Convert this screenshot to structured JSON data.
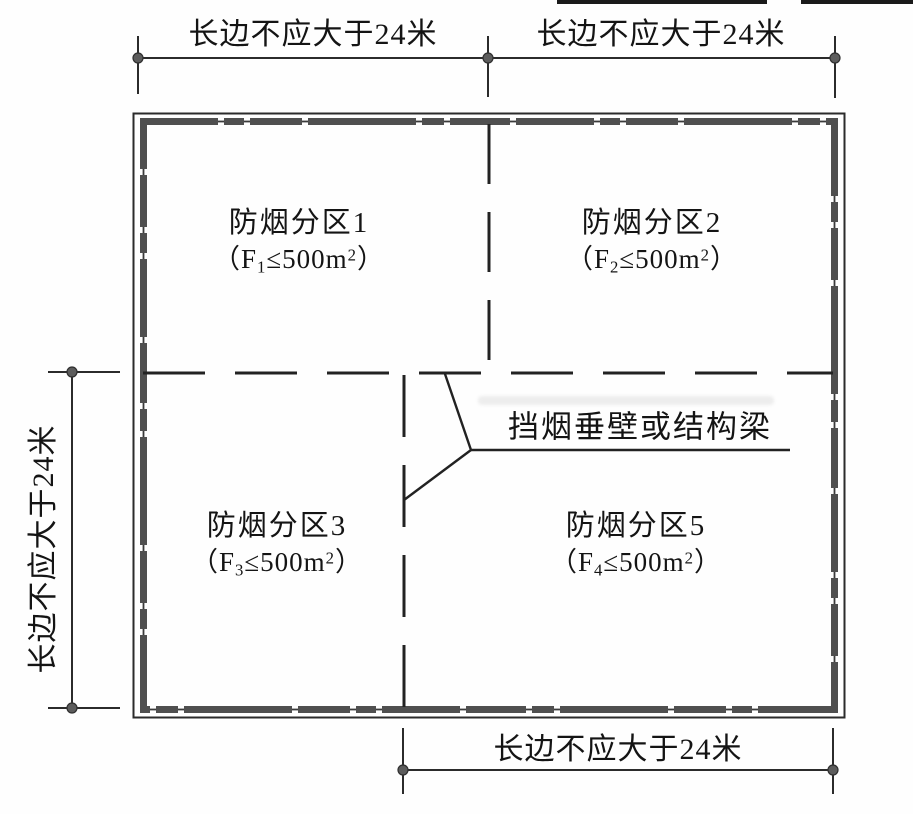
{
  "page": {
    "background": "#fefefe",
    "line_color": "#2b2b2b",
    "wall_color": "#4f4f4f",
    "marker_color": "#5c5c5c",
    "text_color": "#141414"
  },
  "dimensions": {
    "top_left": "长边不应大于24米",
    "top_right": "长边不应大于24米",
    "left": "长边不应大于24米",
    "bottom": "长边不应大于24米"
  },
  "zones": [
    {
      "title": "防烟分区1",
      "area_prefix": "（F",
      "area_sub": "1",
      "area_suffix": "≤500m",
      "area_sup": "2",
      "area_close": "）"
    },
    {
      "title": "防烟分区2",
      "area_prefix": "（F",
      "area_sub": "2",
      "area_suffix": "≤500m",
      "area_sup": "2",
      "area_close": "）"
    },
    {
      "title": "防烟分区3",
      "area_prefix": "（F",
      "area_sub": "3",
      "area_suffix": "≤500m",
      "area_sup": "2",
      "area_close": "）"
    },
    {
      "title": "防烟分区5",
      "area_prefix": "（F",
      "area_sub": "4",
      "area_suffix": "≤500m",
      "area_sup": "2",
      "area_close": "）"
    }
  ],
  "callout": {
    "label": "挡烟垂壁或结构梁"
  }
}
